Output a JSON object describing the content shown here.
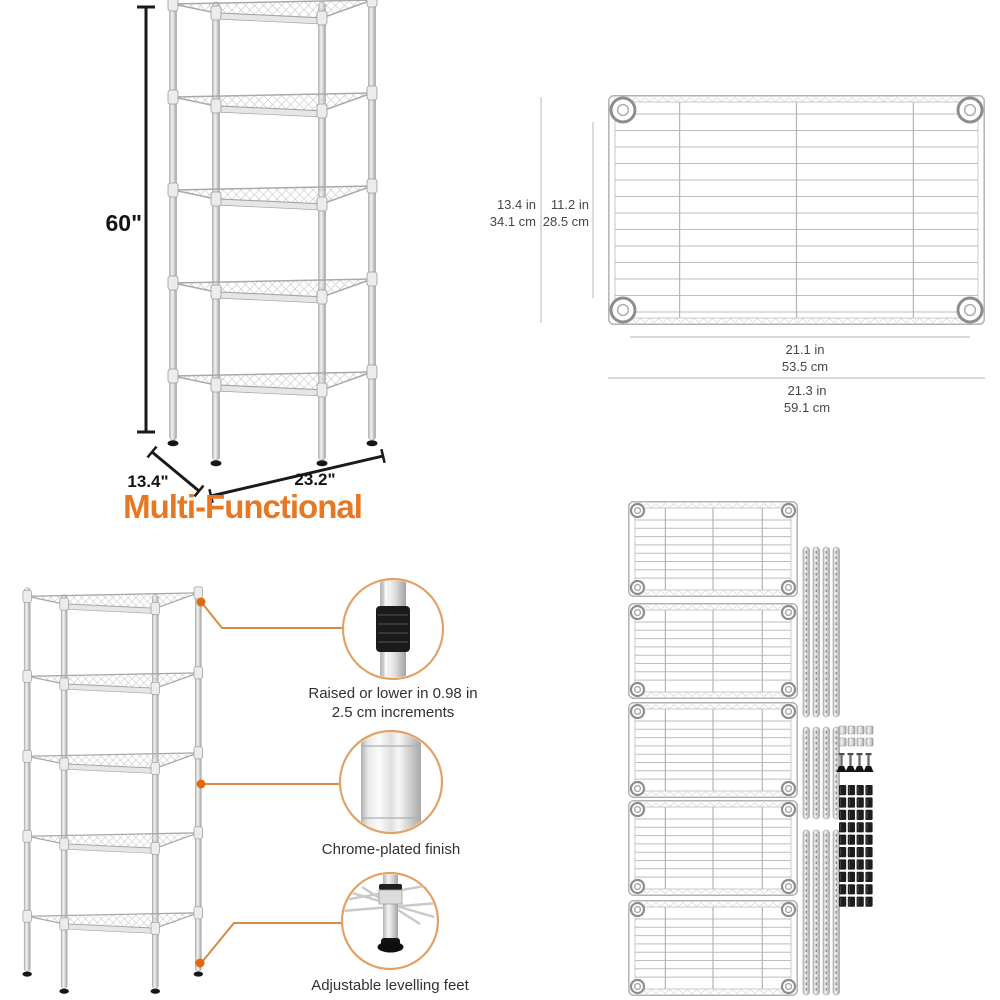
{
  "colors": {
    "accent_orange": "#e87722",
    "callout_circle_stroke": "#e2a266",
    "callout_dot": "#e2690f",
    "connector_line": "#d88b45",
    "dimension_text": "#474747",
    "caption_text": "#313131",
    "metal_gray": "#c9c9c9"
  },
  "overview": {
    "height_label": "60\"",
    "depth_label": "13.4\"",
    "width_label": "23.2\"",
    "caption": "Multi-Functional"
  },
  "panel_dimensions": {
    "outer_depth": {
      "inches": "13.4 in",
      "centimeters": "34.1 cm"
    },
    "inner_depth": {
      "inches": "11.2 in",
      "centimeters": "28.5 cm"
    },
    "inner_width": {
      "inches": "21.1 in",
      "centimeters": "53.5 cm"
    },
    "outer_width": {
      "inches": "21.3 in",
      "centimeters": "59.1 cm"
    }
  },
  "features": [
    {
      "line1": "Raised or lower in 0.98 in",
      "line2": "2.5 cm increments"
    },
    {
      "line1": "Chrome-plated finish",
      "line2": ""
    },
    {
      "line1": "Adjustable levelling feet",
      "line2": ""
    }
  ],
  "parts_kit": {
    "shelf_panels": 5,
    "pole_groups": [
      {
        "count": 4,
        "length": "long"
      },
      {
        "count": 4,
        "length": "short"
      },
      {
        "count": 4,
        "length": "long"
      }
    ],
    "end_caps": 8,
    "leveling_feet": 4,
    "plastic_clips": 40
  }
}
